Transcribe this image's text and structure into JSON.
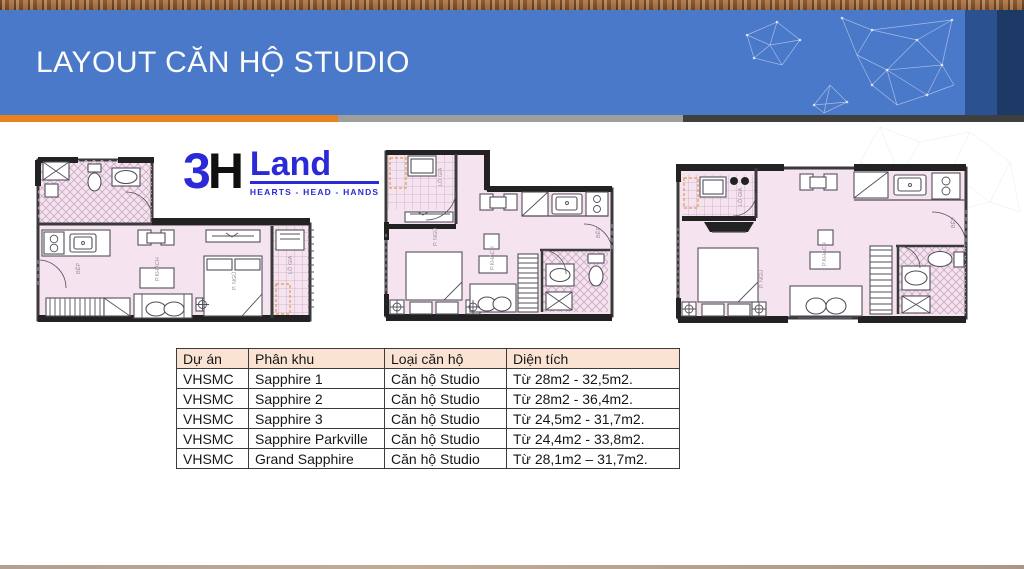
{
  "slide": {
    "title": "LAYOUT CĂN HỘ STUDIO"
  },
  "logo": {
    "digit": "3",
    "letter": "H",
    "brand": "Land",
    "tagline": "HEARTS - HEAD - HANDS"
  },
  "plans": {
    "labels": {
      "loggia": "LÔ GIA",
      "living": "P.KHÁCH",
      "bedroom": "P. NGỦ",
      "kitchen": "BẾP"
    }
  },
  "table": {
    "columns": [
      "Dự án",
      "Phân khu",
      "Loại căn hộ",
      "Diện tích"
    ],
    "rows": [
      [
        "VHSMC",
        "Sapphire 1",
        "Căn hộ Studio",
        "Từ 28m2 - 32,5m2."
      ],
      [
        "VHSMC",
        "Sapphire 2",
        "Căn hộ Studio",
        "Từ 28m2 - 36,4m2."
      ],
      [
        "VHSMC",
        "Sapphire 3",
        "Căn hộ Studio",
        "Từ 24,5m2 - 31,7m2."
      ],
      [
        "VHSMC",
        "Sapphire Parkville",
        "Căn hộ Studio",
        "Từ 24,4m2 - 33,8m2."
      ],
      [
        "VHSMC",
        "Grand Sapphire",
        "Căn hộ Studio",
        "Từ 28,1m2 – 31,7m2."
      ]
    ]
  },
  "colors": {
    "header_blue": "#4a79c9",
    "header_navy": "#1d3966",
    "accent_orange": "#e8821f",
    "table_header_bg": "#fbe3d3",
    "plan_floor_pink": "#f5e3f0",
    "logo_blue": "#2a2ad6"
  }
}
